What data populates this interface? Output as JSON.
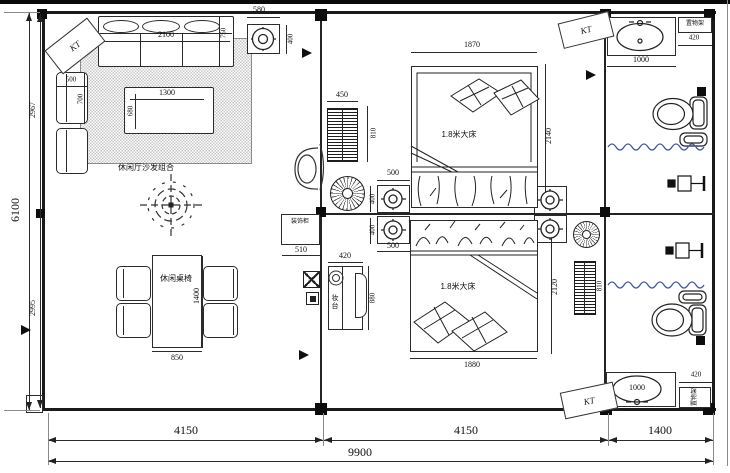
{
  "plan": {
    "ac_label": "KT",
    "living": {
      "sofa_area_label": "休闲厅沙发组合",
      "dining_label": "休闲桌椅",
      "cabinet_label": "装饰柜",
      "sofa_w": "2100",
      "sofa_d": "750",
      "light_w": "580",
      "light_h": "400",
      "armchair_w": "500",
      "armchair_d": "700",
      "coffee_w": "1300",
      "coffee_d": "680",
      "dining_w": "850",
      "dining_l": "1400",
      "cabinet_w": "510"
    },
    "bed1": {
      "label": "1.8米大床",
      "w": "1870",
      "l": "2140",
      "rad_w": "450",
      "rad_h": "810",
      "light_w": "500",
      "light_h": "400"
    },
    "bed2": {
      "label": "1.8米大床",
      "w": "1880",
      "l": "2120",
      "rad_h": "810",
      "light_w": "500",
      "light_h": "400",
      "dresser_label": "妆台",
      "dresser_w": "420",
      "dresser_l": "880"
    },
    "bath": {
      "shelf_label": "置物架",
      "vanity_w": "1000",
      "shelf_w": "420"
    },
    "dims": {
      "bottom_left": "4150",
      "bottom_mid": "4150",
      "bottom_right": "1400",
      "bottom_total": "9900",
      "left_total": "6100",
      "left_upper": "2967",
      "left_lower": "2995"
    },
    "colors": {
      "wave": "#3c55b5",
      "line": "#2b2b2b"
    }
  }
}
